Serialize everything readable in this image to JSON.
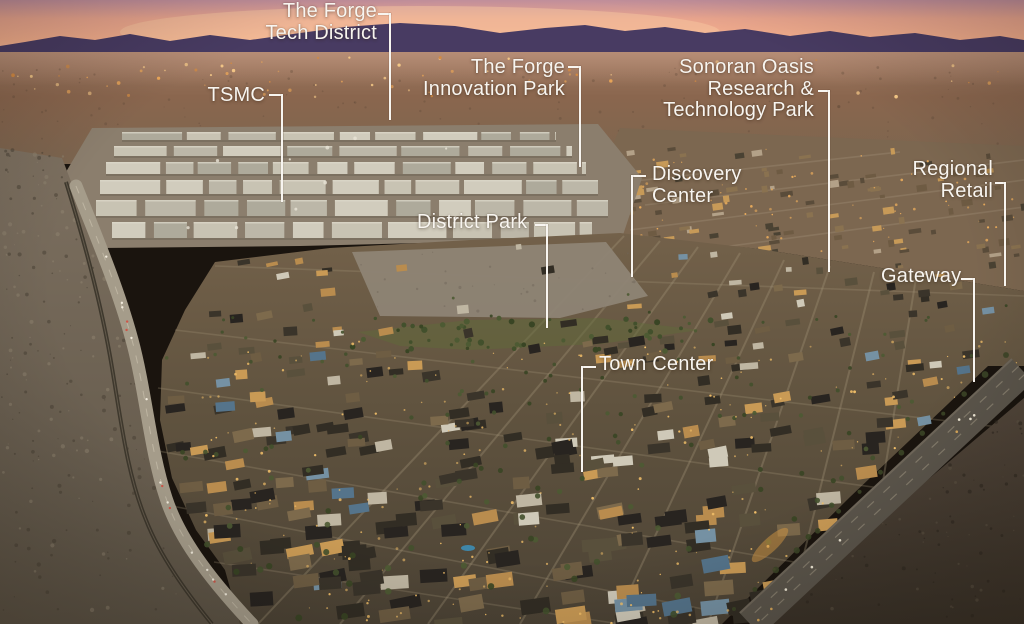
{
  "scene": {
    "description": "Dusk aerial rendering of a desert master-planned semiconductor district with white annotation labels and leader lines",
    "palette": {
      "label_text": "#f8f5f0",
      "leader_line": "#f8f5f0",
      "sky_top": "#c08e9b",
      "sky_peach": "#f2ad8b",
      "mountain": "#483b62",
      "far_desert": "#8a664e",
      "fab_gray": "#c3beaf",
      "development_brown": "#5f5340",
      "city_light_amber": "#eaa85c",
      "foreground_desert": "#6f6454",
      "dark_desert": "#443b2f"
    },
    "labels": {
      "forge_tech_district": {
        "lines": [
          "The Forge",
          "Tech District"
        ]
      },
      "tsmc": {
        "lines": [
          "TSMC"
        ]
      },
      "forge_innovation_park": {
        "lines": [
          "The Forge",
          "Innovation Park"
        ]
      },
      "sonoran_oasis_research_technology_park": {
        "lines": [
          "Sonoran Oasis",
          "Research &",
          "Technology Park"
        ]
      },
      "discovery_center": {
        "lines": [
          "Discovery",
          "Center"
        ]
      },
      "regional_retail": {
        "lines": [
          "Regional",
          "Retail"
        ]
      },
      "district_park": {
        "lines": [
          "District Park"
        ]
      },
      "gateway": {
        "lines": [
          "Gateway"
        ]
      },
      "town_center": {
        "lines": [
          "Town Center"
        ]
      }
    }
  }
}
